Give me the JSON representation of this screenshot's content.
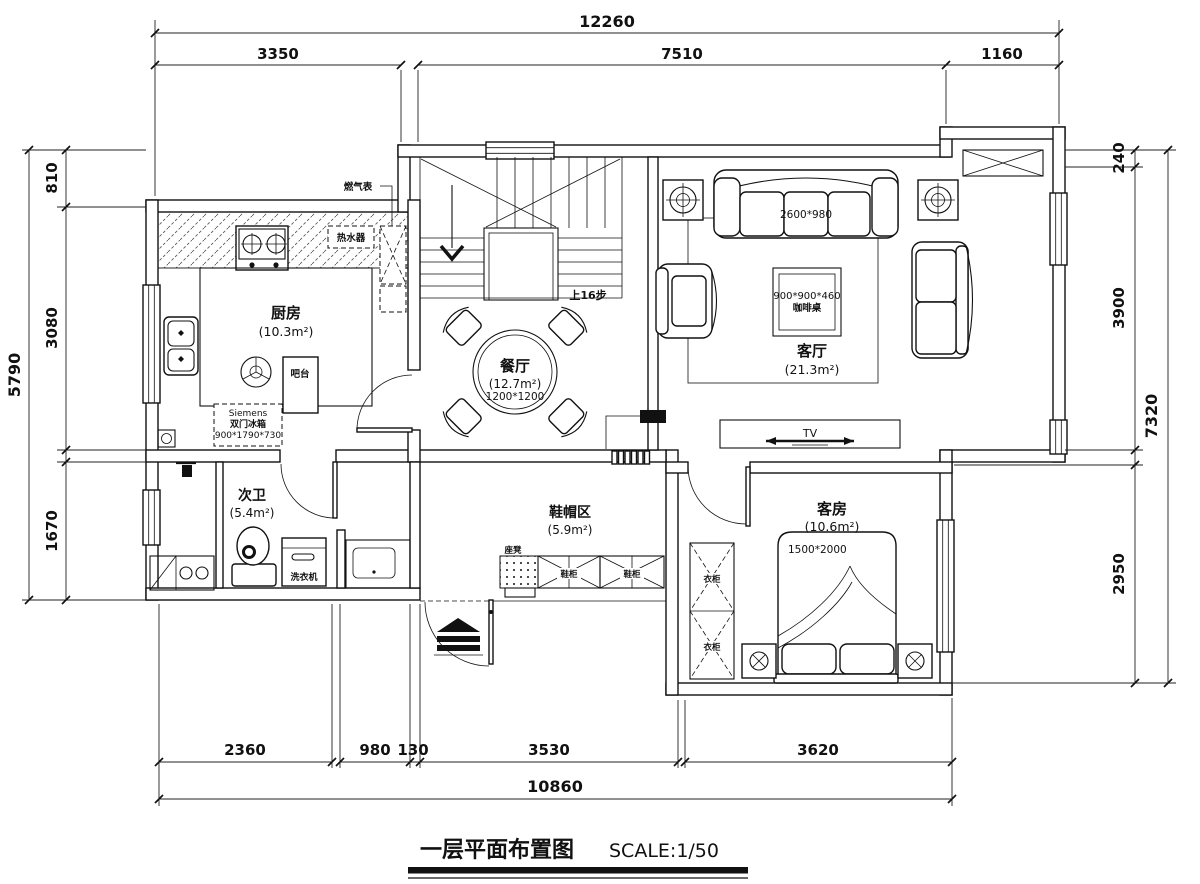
{
  "title": {
    "text": "一层平面布置图",
    "scale": "SCALE:1/50"
  },
  "rooms": {
    "kitchen": {
      "name": "厨房",
      "area": "(10.3m²)"
    },
    "dining": {
      "name": "餐厅",
      "area": "(12.7m²)",
      "table_size": "1200*1200"
    },
    "living": {
      "name": "客厅",
      "area": "(21.3m²)"
    },
    "bath": {
      "name": "次卫",
      "area": "(5.4m²)"
    },
    "cloak": {
      "name": "鞋帽区",
      "area": "(5.9m²)"
    },
    "guest": {
      "name": "客房",
      "area": "(10.6m²)",
      "bed_size": "1500*2000"
    }
  },
  "annotations": {
    "gas_meter": "燃气表",
    "water_heater": "热水器",
    "bar_counter": "吧台",
    "fridge_brand": "Siemens",
    "fridge_type": "双门冰箱",
    "fridge_size": "900*1790*730",
    "stairs_note": "上16步",
    "sofa_size": "2600*980",
    "coffee_table_size": "900*900*460",
    "coffee_table_name": "咖啡桌",
    "tv": "TV",
    "washing_machine": "洗衣机",
    "bench": "座凳",
    "shoe_cabinet": "鞋柜",
    "wardrobe": "衣柜"
  },
  "dimensions": {
    "top": {
      "overall": "12260",
      "segments": [
        "3350",
        "7510",
        "1160"
      ]
    },
    "bottom": {
      "overall": "10860",
      "segments": [
        "2360",
        "980",
        "130",
        "3530",
        "3620"
      ]
    },
    "left": {
      "overall": "5790",
      "segments": [
        "810",
        "3080",
        "1670"
      ]
    },
    "right": {
      "overall": "7320",
      "segments": [
        "240",
        "3900",
        "2950"
      ]
    }
  }
}
